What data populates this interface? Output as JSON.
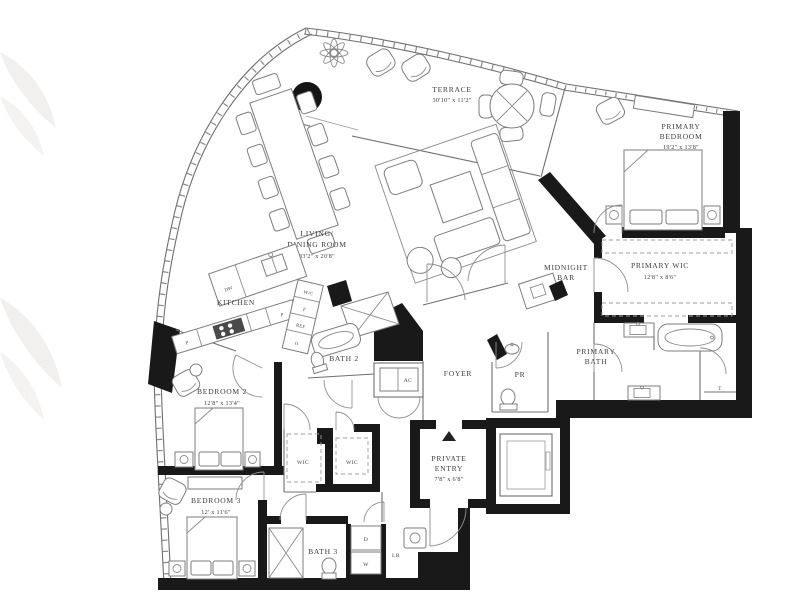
{
  "rooms": {
    "terrace": {
      "label": "TERRACE",
      "dims": "30'10\" x 11'2\""
    },
    "living_dining": {
      "label_line1": "LIVING/",
      "label_line2": "DINING ROOM",
      "dims": "33'2\" x 20'8\""
    },
    "kitchen": {
      "label": "KITCHEN"
    },
    "primary_bedroom": {
      "label_line1": "PRIMARY",
      "label_line2": "BEDROOM",
      "dims": "19'2\" x 13'8\""
    },
    "primary_wic": {
      "label": "PRIMARY WIC",
      "dims": "12'8\" x 8'6\""
    },
    "primary_bath": {
      "label_line1": "PRIMARY",
      "label_line2": "BATH"
    },
    "midnight_bar": {
      "label_line1": "MIDNIGHT",
      "label_line2": "BAR"
    },
    "bath_2": {
      "label": "BATH 2"
    },
    "bath_3": {
      "label": "BATH 3"
    },
    "bedroom_2": {
      "label": "BEDROOM 2",
      "dims": "12'8\" x 13'4\""
    },
    "bedroom_3": {
      "label": "BEDROOM 3",
      "dims": "12' x 11'6\""
    },
    "foyer": {
      "label": "FOYER"
    },
    "powder_room": {
      "label": "PR"
    },
    "ac_closet": {
      "label": "AC"
    },
    "wic_left": {
      "label": "WIC"
    },
    "wic_right": {
      "label": "WIC"
    },
    "private_entry": {
      "label_line1": "PRIVATE",
      "label_line2": "ENTRY",
      "dims": "7'8\" x 6'8\""
    },
    "laundry": {
      "label": "LR"
    }
  },
  "appliances": {
    "dishwasher": "DW",
    "wine_cooler": "W/C",
    "freezer": "F",
    "refrigerator": "REF",
    "oven": "O",
    "pantry_left": "P",
    "pantry_right": "P",
    "dryer": "D",
    "washer": "W",
    "shower_valve": "T"
  },
  "colors": {
    "wall": "#191919",
    "line": "#6f6f6f",
    "label": "#3d3d3d",
    "watermark": "#f1f0ee"
  }
}
